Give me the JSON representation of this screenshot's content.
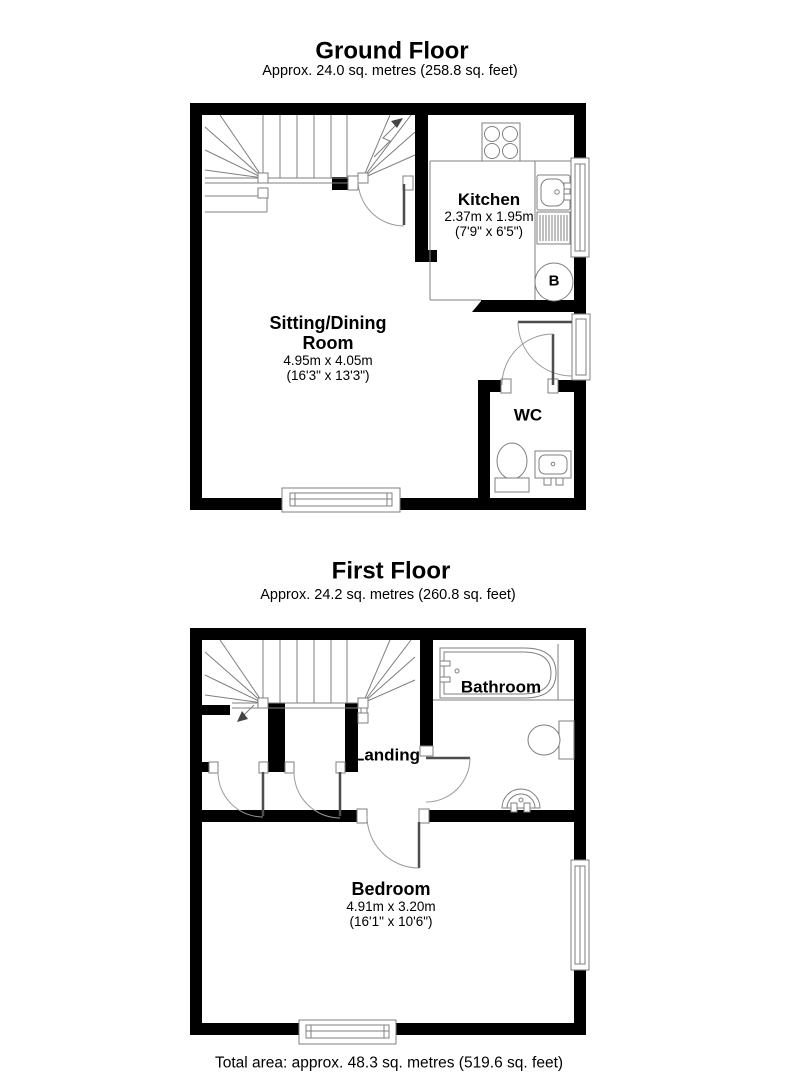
{
  "colors": {
    "wall": "#000000",
    "line": "#7f7f7f",
    "leaf": "#4d4d4d",
    "text": "#000000",
    "bg": "#ffffff"
  },
  "ground_floor": {
    "title": "Ground Floor",
    "subtitle": "Approx. 24.0 sq. metres (258.8 sq. feet)",
    "kitchen": {
      "name": "Kitchen",
      "dims_metric": "2.37m x 1.95m",
      "dims_imperial": "(7'9\" x 6'5\")"
    },
    "sitting_dining": {
      "name_line1": "Sitting/Dining",
      "name_line2": "Room",
      "dims_metric": "4.95m x 4.05m",
      "dims_imperial": "(16'3\" x 13'3\")"
    },
    "wc": {
      "name": "WC"
    },
    "boiler": {
      "label": "B"
    }
  },
  "first_floor": {
    "title": "First Floor",
    "subtitle": "Approx. 24.2 sq. metres (260.8 sq. feet)",
    "bathroom": {
      "name": "Bathroom"
    },
    "landing": {
      "name": "Landing"
    },
    "bedroom": {
      "name": "Bedroom",
      "dims_metric": "4.91m x 3.20m",
      "dims_imperial": "(16'1\" x 10'6\")"
    }
  },
  "footer": {
    "total_area": "Total area: approx. 48.3 sq. metres (519.6 sq. feet)"
  }
}
